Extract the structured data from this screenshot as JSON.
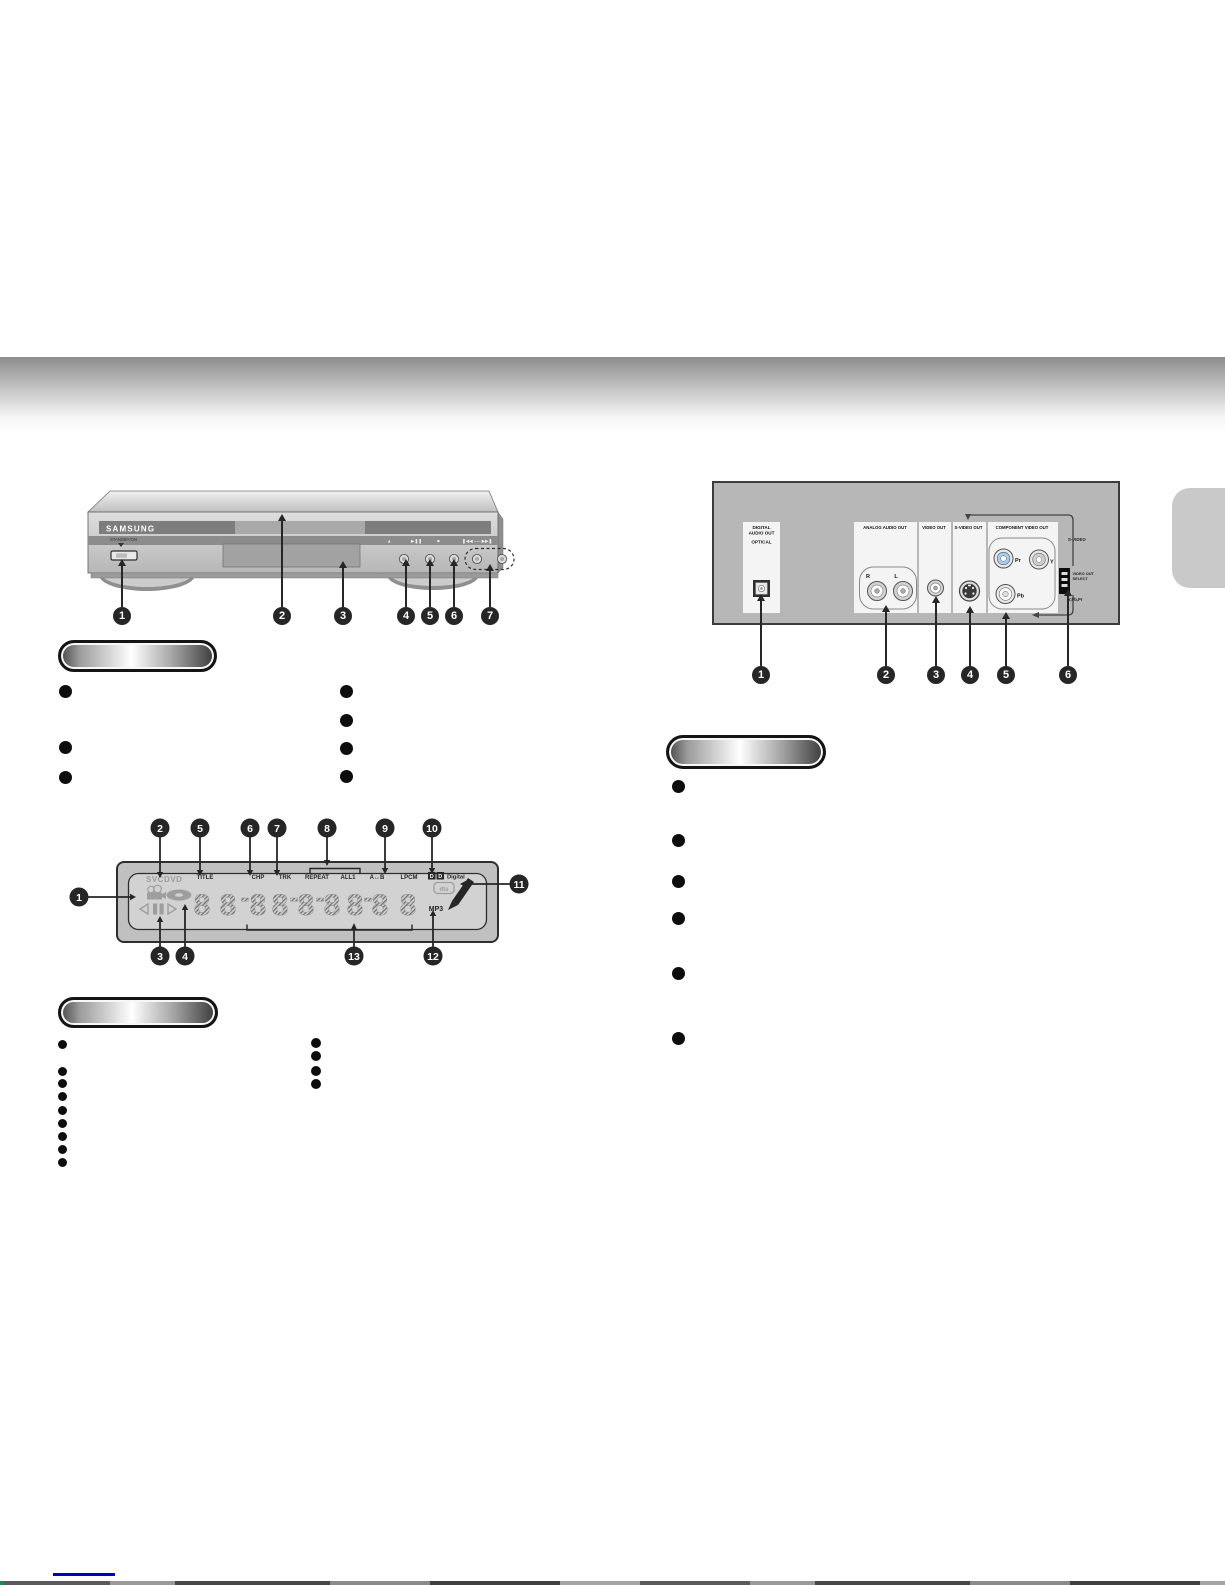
{
  "front_panel": {
    "brand": "SAMSUNG",
    "standby_label": "STANDBY/ON",
    "transport": {
      "open_close": "▲",
      "play_pause": "▶❚❚",
      "stop": "■",
      "skip": "❚◀◀ ── ▶▶❚"
    },
    "callouts": [
      "1",
      "2",
      "3",
      "4",
      "5",
      "6",
      "7"
    ]
  },
  "rear_panel": {
    "digital_audio_out_line1": "DIGITAL",
    "digital_audio_out_line2": "AUDIO OUT",
    "optical": "OPTICAL",
    "analog_audio_out": "ANALOG AUDIO OUT",
    "video_out": "VIDEO OUT",
    "s_video_out": "S-VIDEO OUT",
    "component_video_out": "COMPONENT VIDEO OUT",
    "jack_r": "R",
    "jack_l": "L",
    "jack_pr": "Pr",
    "jack_y": "Y",
    "jack_pb": "Pb",
    "side_s_video": "S-VIDEO",
    "side_select_line1": "VIDEO OUT",
    "side_select_line2": "SELECT",
    "side_ypbpr": "Y,Pb,Pr",
    "callouts": [
      "1",
      "2",
      "3",
      "4",
      "5",
      "6"
    ]
  },
  "display_panel": {
    "disc_types": "SVCDVD",
    "title": "TITLE",
    "chp": "CHP",
    "trk": "TRK",
    "repeat": "REPEAT",
    "all1": "ALL1",
    "a_b": "A↔B",
    "lpcm": "LPCM",
    "dolby_d": "D",
    "dolby_digital": "Digital",
    "dts": "dts",
    "mp3": "MP3",
    "digit": "8",
    "callouts": [
      "1",
      "2",
      "3",
      "4",
      "5",
      "6",
      "7",
      "8",
      "9",
      "10",
      "11",
      "12",
      "13"
    ]
  },
  "legend_sections": {
    "front": {
      "left_bullet_count": 3,
      "right_bullet_count": 4
    },
    "display": {
      "left_bullet_count": 9,
      "right_bullet_count": 4
    },
    "rear": {
      "bullet_count": 6
    }
  }
}
